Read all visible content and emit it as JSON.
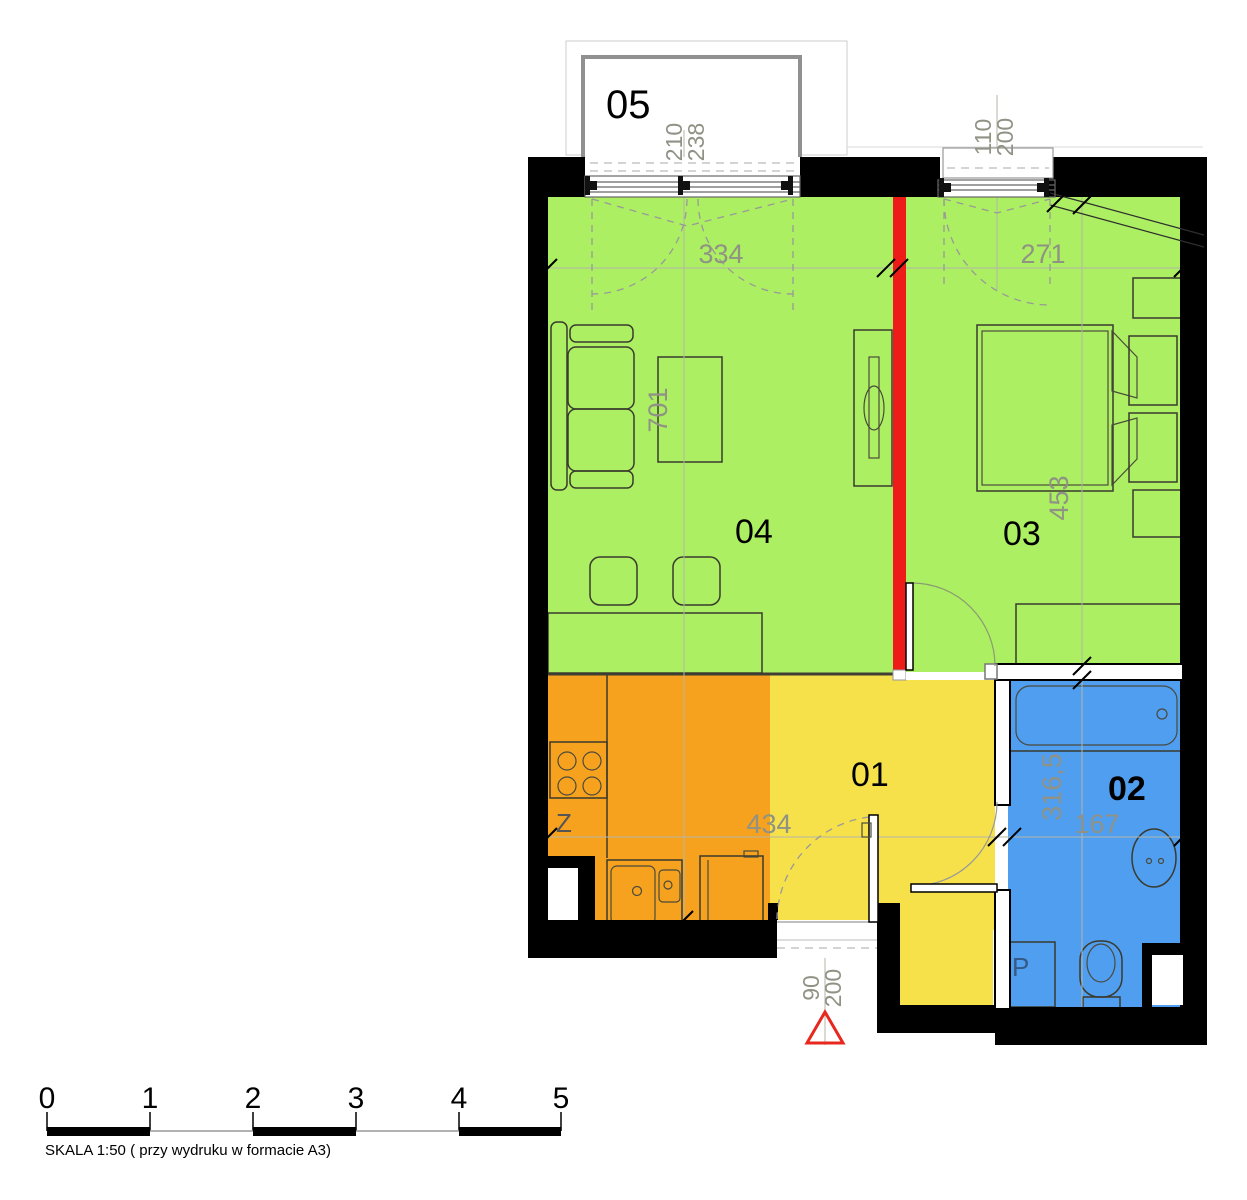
{
  "colors": {
    "wall": "#000000",
    "room_living": "#ACEF62",
    "room_bedroom": "#ACEF62",
    "kitchen": "#F6A21E",
    "hall": "#F6E14B",
    "bath": "#4F9EF0",
    "red_wall": "#EE1C19",
    "dim_text": "#8F9284",
    "dim_line": "#B5B5A8",
    "balcony_border": "#909090",
    "entry_marker": "#E8281E"
  },
  "rooms": {
    "r01": {
      "label": "01"
    },
    "r02": {
      "label": "02"
    },
    "r03": {
      "label": "03"
    },
    "r04": {
      "label": "04"
    },
    "r05": {
      "label": "05"
    }
  },
  "fixtures": {
    "sink_label": "Z",
    "washer_label": "P"
  },
  "dimensions": {
    "living_width": "334",
    "bedroom_width": "271",
    "table": "701",
    "bed": "453",
    "kitchen_hall_width": "434",
    "bath_length": "316,5",
    "bath_width": "167",
    "balcony_door_w": "210",
    "balcony_door_h": "238",
    "window_w": "110",
    "window_h": "200",
    "entry_door_w": "90",
    "entry_door_h": "200"
  },
  "scalebar": {
    "ticks": [
      "0",
      "1",
      "2",
      "3",
      "4",
      "5"
    ],
    "caption": "SKALA 1:50 ( przy wydruku w formacie A3)"
  }
}
